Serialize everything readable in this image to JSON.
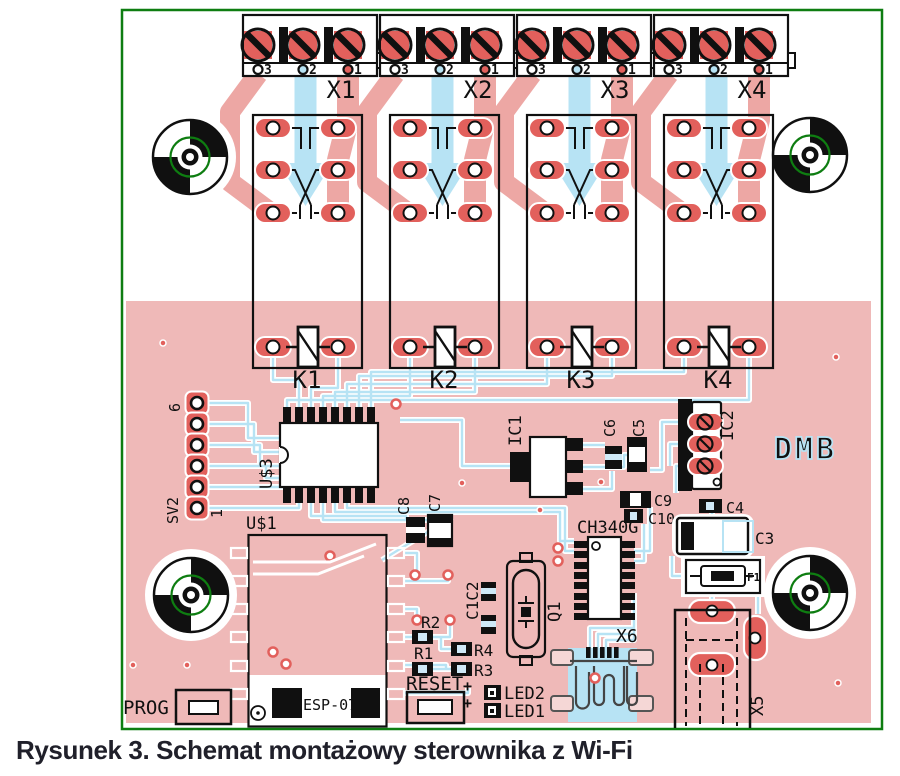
{
  "caption": "Rysunek 3. Schemat montażowy sterownika z Wi-Fi",
  "board": {
    "watermark": "DMB",
    "terminals": {
      "pin_labels": [
        "3",
        "2",
        "1"
      ],
      "items": [
        {
          "label": "X1"
        },
        {
          "label": "X2"
        },
        {
          "label": "X3"
        },
        {
          "label": "X4"
        }
      ]
    },
    "relays": [
      {
        "label": "K1"
      },
      {
        "label": "K2"
      },
      {
        "label": "K3"
      },
      {
        "label": "K4"
      }
    ],
    "components": {
      "sv2": "SV2",
      "sv2_pin_first": "1",
      "sv2_pin_last": "6",
      "u3": "U$3",
      "u1": "U$1",
      "esp_module": "ESP-07",
      "ic1": "IC1",
      "ic2": "IC2",
      "usb_uart": "CH340G",
      "q1": "Q1",
      "c1c2": "C1C2",
      "c3": "C3",
      "c4": "C4",
      "c5": "C5",
      "c6": "C6",
      "c7": "C7",
      "c8": "C8",
      "c9": "C9",
      "c10": "C10",
      "r1": "R1",
      "r2": "R2",
      "r3": "R3",
      "r4": "R4",
      "led1": "LED1",
      "led2": "LED2",
      "plus": "+",
      "f1": "F1",
      "x5": "X5",
      "x6": "X6",
      "prog": "PROG",
      "reset": "RESET"
    }
  },
  "colors": {
    "copper_pour": "#efb9b8",
    "pad_red": "#e2605c",
    "trace_red": "#eda7a4",
    "trace_blue": "#b7e3f4",
    "board_outline_green": "#0e7d11",
    "silkscreen": "#101010",
    "caption_text": "#20202a"
  }
}
